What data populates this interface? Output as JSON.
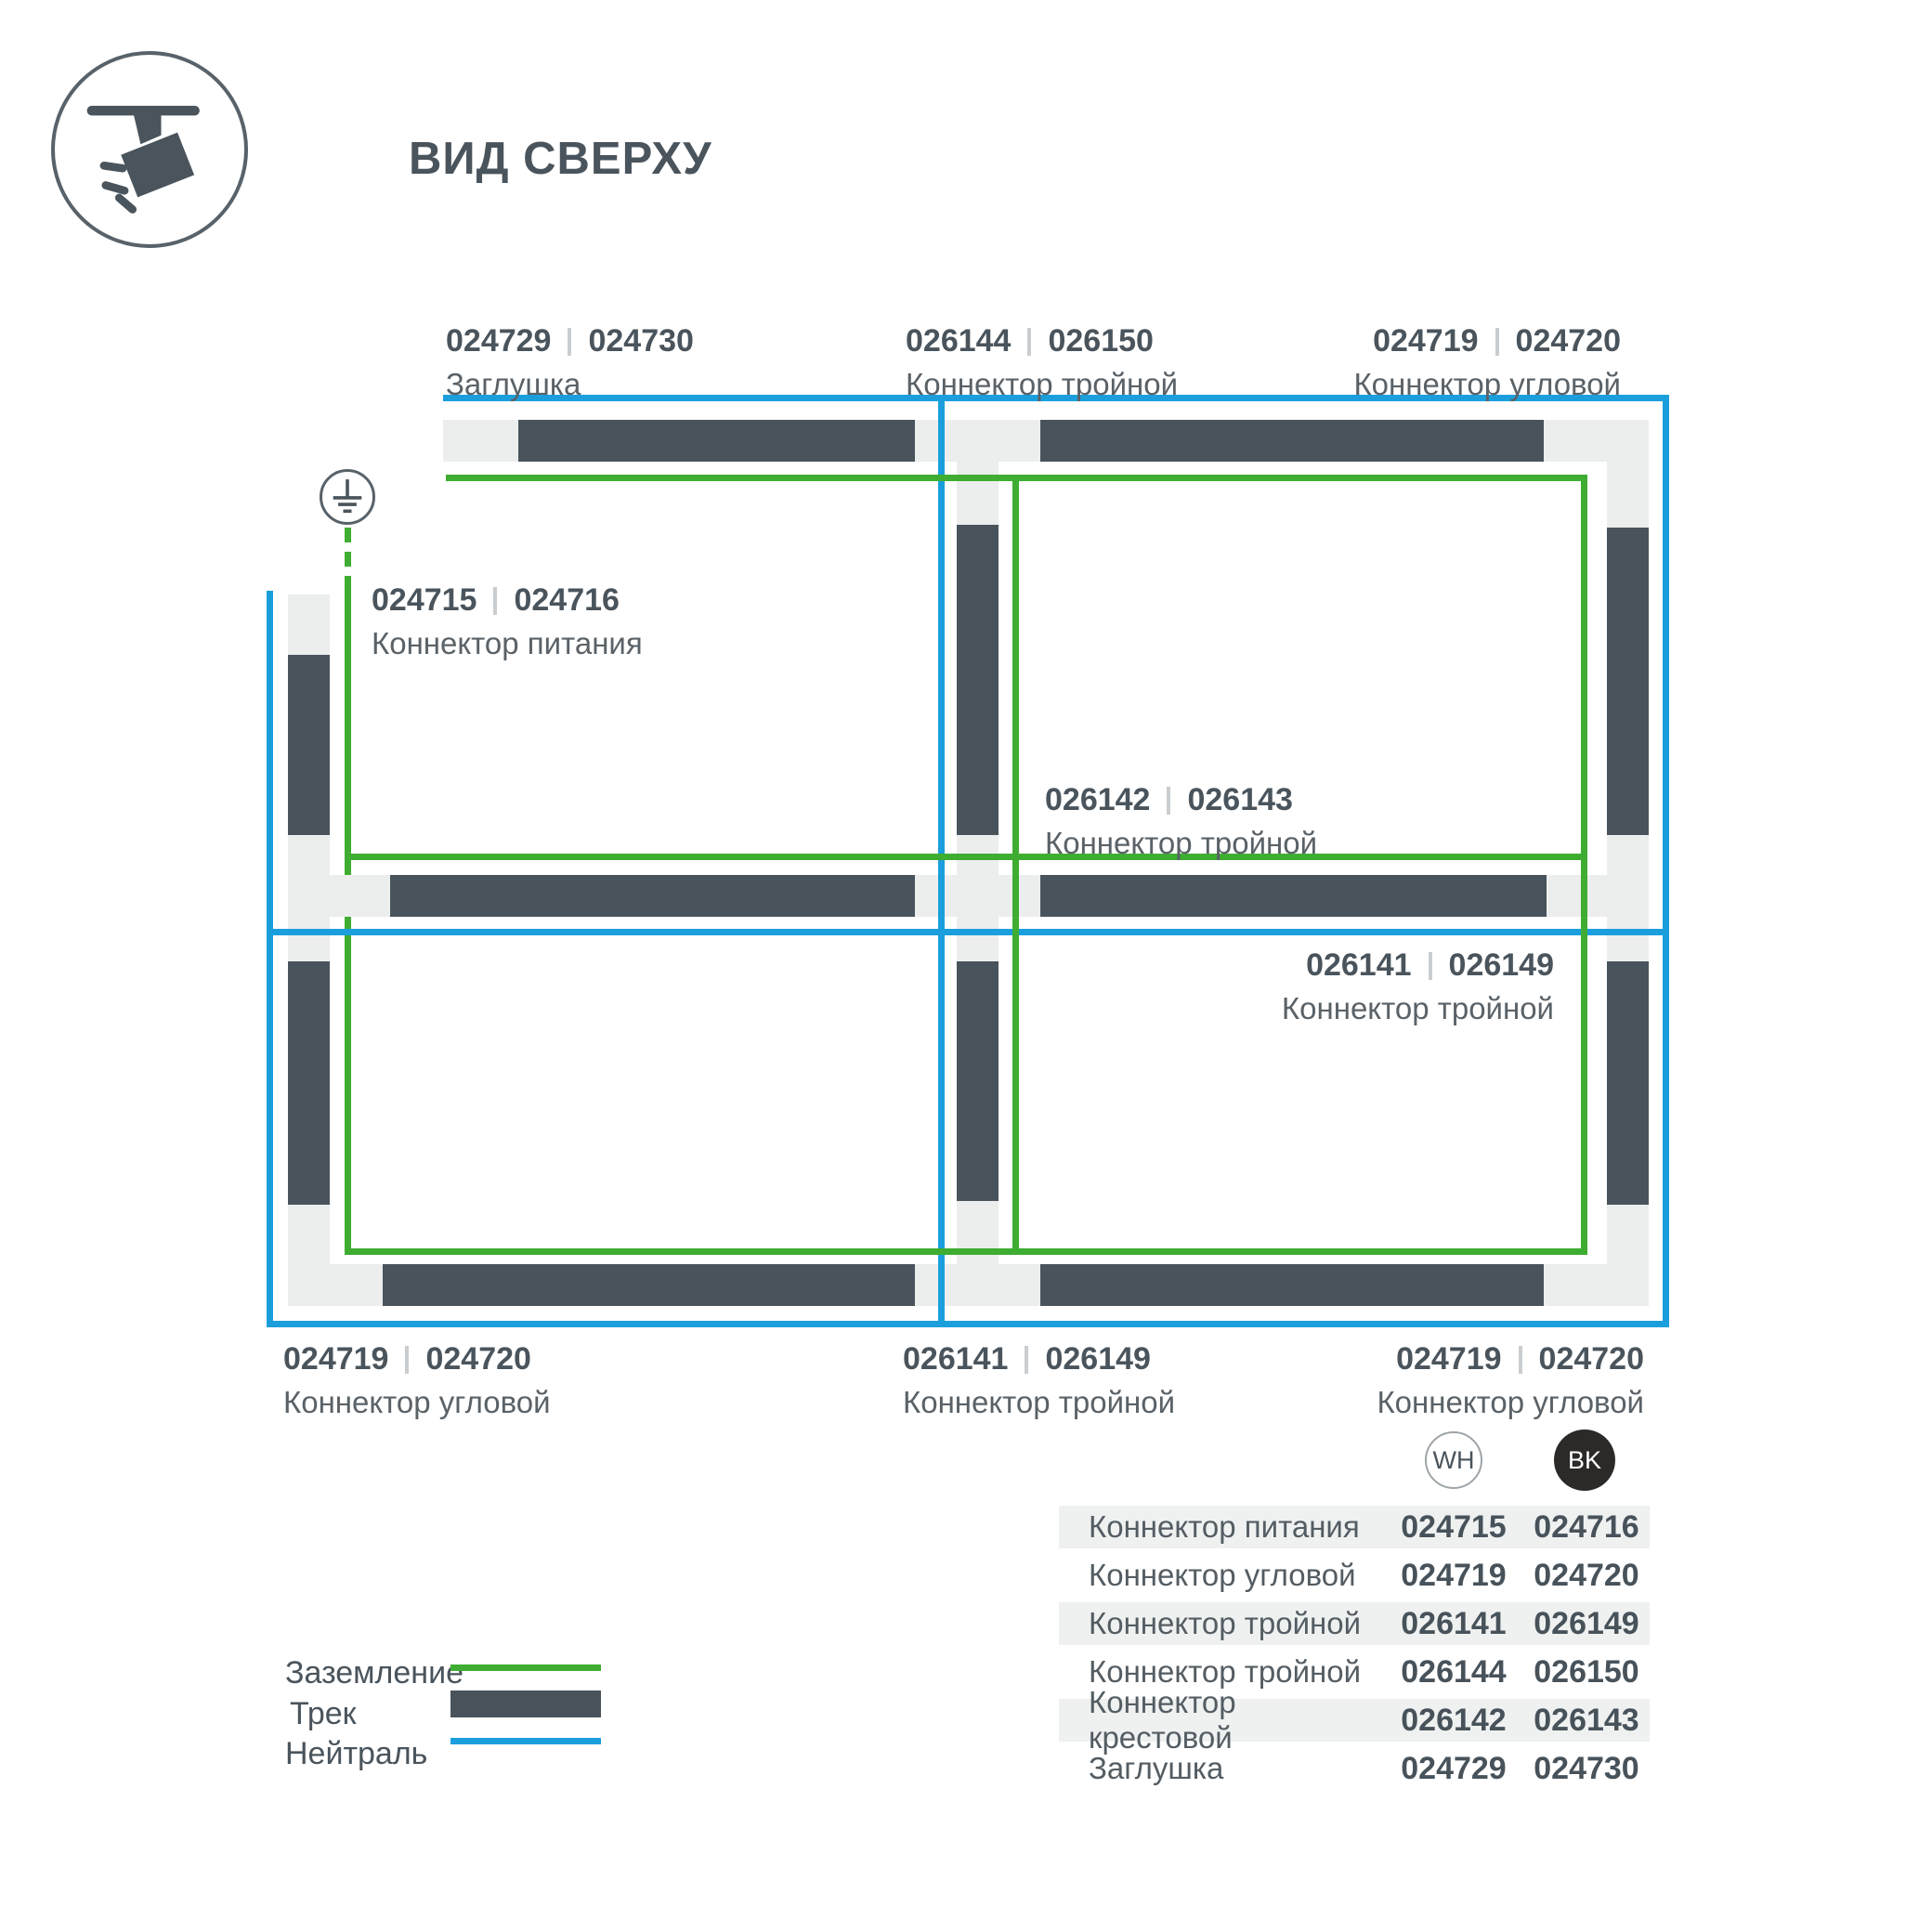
{
  "title": "ВИД СВЕРХУ",
  "colors": {
    "track": "#48535B",
    "connector": "#ECEEEE",
    "ground_green": "#3EAD32",
    "neutral_blue": "#1B9FDC",
    "text_dark": "#4A545C",
    "text_muted": "#5A6268",
    "table_row_shade": "#EFF1F1",
    "badge_black": "#2B2A28"
  },
  "diagram": {
    "labels": [
      {
        "code_wh": "024729",
        "code_bk": "024730",
        "name": "Заглушка"
      },
      {
        "code_wh": "026144",
        "code_bk": "026150",
        "name": "Коннектор тройной"
      },
      {
        "code_wh": "024719",
        "code_bk": "024720",
        "name": "Коннектор угловой"
      },
      {
        "code_wh": "024715",
        "code_bk": "024716",
        "name": "Коннектор питания"
      },
      {
        "code_wh": "026142",
        "code_bk": "026143",
        "name": "Коннектор тройной"
      },
      {
        "code_wh": "026141",
        "code_bk": "026149",
        "name": "Коннектор тройной"
      },
      {
        "code_wh": "024719",
        "code_bk": "024720",
        "name": "Коннектор угловой"
      },
      {
        "code_wh": "026141",
        "code_bk": "026149",
        "name": "Коннектор тройной"
      },
      {
        "code_wh": "024719",
        "code_bk": "024720",
        "name": "Коннектор угловой"
      }
    ]
  },
  "legend": {
    "items": [
      {
        "label": "Заземление"
      },
      {
        "label": "Трек"
      },
      {
        "label": "Нейтраль"
      }
    ]
  },
  "badges": {
    "wh": "WH",
    "bk": "BK"
  },
  "table": {
    "rows": [
      {
        "label": "Коннектор питания",
        "wh": "024715",
        "bk": "024716"
      },
      {
        "label": "Коннектор угловой",
        "wh": "024719",
        "bk": "024720"
      },
      {
        "label": "Коннектор тройной",
        "wh": "026141",
        "bk": "026149"
      },
      {
        "label": "Коннектор тройной",
        "wh": "026144",
        "bk": "026150"
      },
      {
        "label": "Коннектор крестовой",
        "wh": "026142",
        "bk": "026143"
      },
      {
        "label": "Заглушка",
        "wh": "024729",
        "bk": "024730"
      }
    ]
  }
}
